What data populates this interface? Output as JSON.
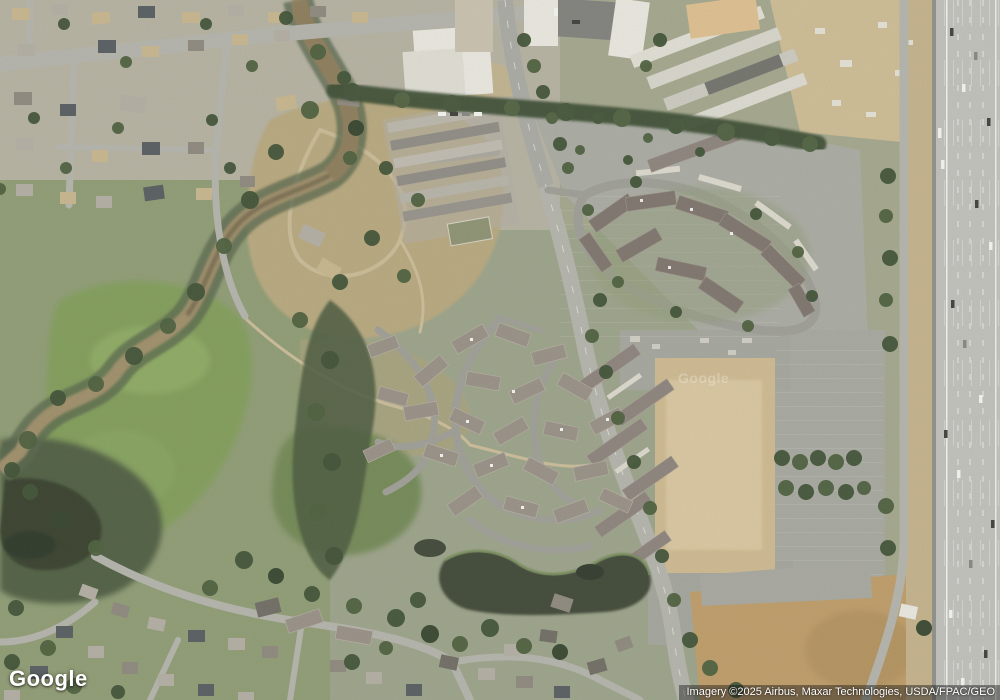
{
  "branding": {
    "logo_text": "Google",
    "tile_watermark_text": "Google"
  },
  "attribution": {
    "imagery_credit": "Imagery ©2025 Airbus, Maxar Technologies, USDA/FPAC/GEO"
  },
  "palette": {
    "grass_meadow": "#7f9b58",
    "tree_dark": "#3d4f33",
    "park_dirt": "#b6a67c",
    "river_mud": "#9d8c67",
    "pond_water": "#3d4536",
    "road_asphalt": "#b2b2aa",
    "freeway_concrete": "#bfbfba",
    "parking_lot": "#a8a9a1",
    "vacant_dirt": "#d0bc94",
    "field_dirt": "#bd9a66",
    "apartment_roof": "#7c726b",
    "condo_roof": "#968e84",
    "industrial_roof": "#e9e7df",
    "construction_dirt": "#ccbb93"
  }
}
